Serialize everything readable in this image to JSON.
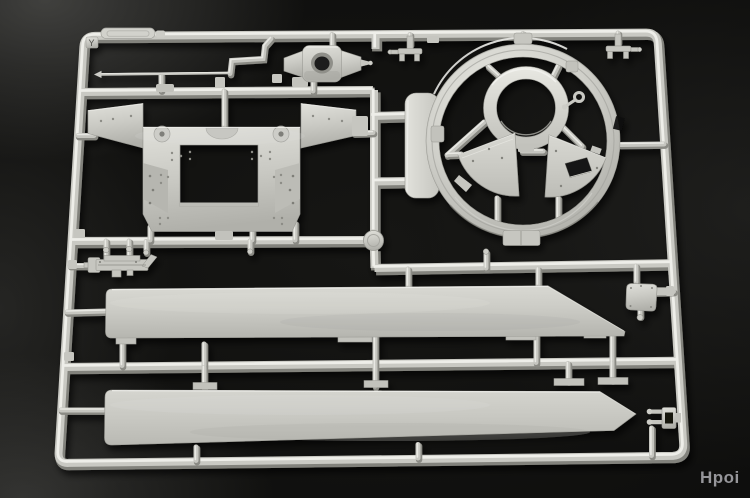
{
  "watermark": {
    "text": "Hpoi",
    "color": "#96969a"
  },
  "sprue": {
    "letter": "Y",
    "colors": {
      "plastic_highlight": "#eeeee9",
      "plastic_main": "#c9c9c3",
      "plastic_shadow": "#82827c",
      "plastic_surface": "#cfcfc9",
      "background": "#111110",
      "watermark_text": "#96969a"
    }
  }
}
